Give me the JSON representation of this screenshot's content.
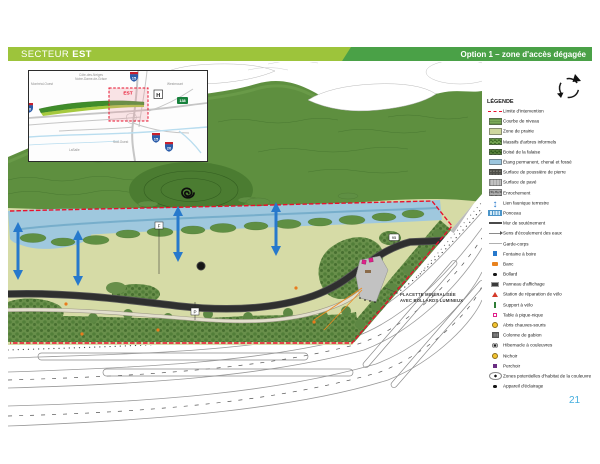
{
  "header": {
    "sector_label": "SECTEUR",
    "sector_name": "EST",
    "option_label": "Option 1 – zone d'accès dégagée"
  },
  "page_number": "21",
  "inset_map": {
    "district_line1": "Côte-des-Neiges",
    "district_line2": "Notre-Dame-de-Grâce",
    "label_west": "Montréal-Ouest",
    "label_east": "Westmount",
    "label_south": "Sud-Ouest",
    "label_southwest": "LaSalle",
    "zone_label": "EST",
    "hospital": "H",
    "shields": {
      "s15a": "15",
      "s15b": "15",
      "s20": "20",
      "s138": "138",
      "s_left": "20"
    }
  },
  "plan": {
    "labels": {
      "placette_line1": "PLACETTE MINÉRALISÉE",
      "placette_line2": "AVEC BOLLARDS LUMINEUX",
      "marker_f": "F",
      "marker_p": "P",
      "sign_95": "95"
    }
  },
  "legend": {
    "title": "LÉGENDE",
    "items": [
      {
        "label": "Limite d'intervention",
        "icon": "limite"
      },
      {
        "label": "Courbe de niveau",
        "icon": "courbe"
      },
      {
        "label": "Zone de prairie",
        "icon": "prairie"
      },
      {
        "label": "Massifs d'arbres informels",
        "icon": "massifs"
      },
      {
        "label": "Boisé de la falaise",
        "icon": "boise"
      },
      {
        "label": "Étang permanent, chenal et fossé",
        "icon": "etang"
      },
      {
        "label": "Surface de poussière de pierre",
        "icon": "pouss"
      },
      {
        "label": "Surface de pavé",
        "icon": "pave"
      },
      {
        "label": "Enrochement",
        "icon": "enroch"
      },
      {
        "label": "Lien faunique terrestre",
        "icon": "lien"
      },
      {
        "label": "Ponceau",
        "icon": "ponceau"
      },
      {
        "label": "Mur de soutènement",
        "icon": "mur"
      },
      {
        "label": "Sens d'écoulement des eaux",
        "icon": "sens"
      },
      {
        "label": "Garde-corps",
        "icon": "garde"
      },
      {
        "label": "Fontaine à boire",
        "icon": "fontaine"
      },
      {
        "label": "Banc",
        "icon": "banc"
      },
      {
        "label": "Bollard",
        "icon": "bollard"
      },
      {
        "label": "Panneau d'affichage",
        "icon": "panneau"
      },
      {
        "label": "Station de réparation de vélo",
        "icon": "station"
      },
      {
        "label": "Support à vélo",
        "icon": "support"
      },
      {
        "label": "Table à pique-nique",
        "icon": "table"
      },
      {
        "label": "Abris chauves-souris",
        "icon": "abris"
      },
      {
        "label": "Colonne de gabion",
        "icon": "gabion"
      },
      {
        "label": "Hibernacle à couleuvres",
        "icon": "hibern"
      },
      {
        "label": "Nichoir",
        "icon": "nichoir"
      },
      {
        "label": "Perchoir",
        "icon": "perchoir"
      },
      {
        "label": "Zones potentielles d'habitat de la couleuvre",
        "icon": "zones"
      },
      {
        "label": "Appareil d'éclairage",
        "icon": "appareil"
      }
    ]
  },
  "colors": {
    "header_light_green": "#9dc43b",
    "header_dark_green": "#4aa147",
    "limite_red": "#e8112d",
    "water_blue": "#9cc6de",
    "wildlife_arrow_blue": "#2779cc",
    "placette_pink": "#e0218a",
    "page_number_blue": "#45aede"
  }
}
